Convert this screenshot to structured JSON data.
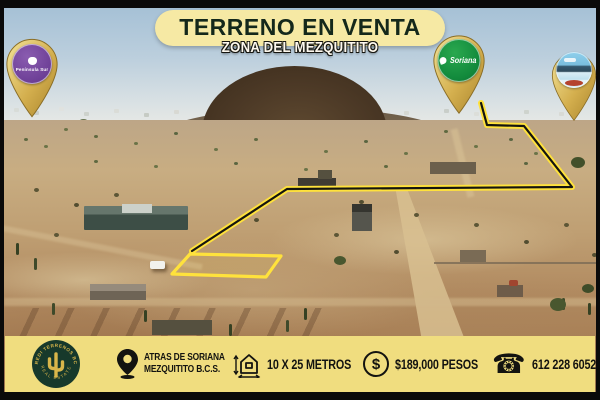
{
  "banner": {
    "title": "TERRENO EN VENTA",
    "subtitle": "ZONA DEL MEZQUITITO"
  },
  "pins": {
    "peninsula": {
      "label": "Península Sur"
    },
    "soriana": {
      "label": "Soriana"
    },
    "emblem": {
      "label": ""
    }
  },
  "footer": {
    "logo": {
      "arc_text": "CREDI TERRENOS BCS",
      "bottom_text": "REAL ESTATE"
    },
    "location": {
      "line1": "ATRAS DE SORIANA",
      "line2": "MEZQUITITO B.C.S."
    },
    "size": {
      "text": "10 X 25 METROS"
    },
    "price": {
      "text": "$189,000 PESOS",
      "currency_symbol": "$"
    },
    "phone": {
      "text": "612 228 6052"
    }
  },
  "colors": {
    "footer_bar": "#f0dd7f",
    "banner_pill": "#f6e9a4",
    "banner_text": "#14281b",
    "pin_gold": "#d9b84d",
    "soriana_green": "#128a3c",
    "peninsula_purple": "#6d3f96",
    "route_yellow": "#ffe23c",
    "logo_green": "#17392b"
  }
}
